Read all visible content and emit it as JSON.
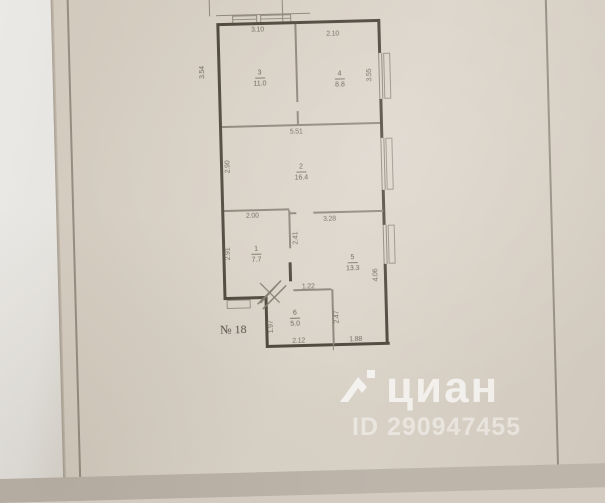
{
  "document": {
    "sheet_number": "№ 18"
  },
  "rooms": [
    {
      "number": "1",
      "area": "7.7"
    },
    {
      "number": "2",
      "area": "16.4"
    },
    {
      "number": "3",
      "area": "11.0"
    },
    {
      "number": "4",
      "area": "8.8"
    },
    {
      "number": "5",
      "area": "13.3"
    },
    {
      "number": "6",
      "area": "5.0"
    }
  ],
  "dimensions": {
    "room3_top": "3.10",
    "room4_top": "2.10",
    "room3_left": "3.54",
    "room4_right": "3.55",
    "room2_top": "5.51",
    "room2_left": "2.90",
    "room1_top": "2.00",
    "room1_left": "2.91",
    "room1_right": "2.41",
    "room5_top": "3.28",
    "room5_right": "4.06",
    "room6_top": "1.22",
    "room6_left": "1.97",
    "room6_right": "2.47",
    "room6_bottom": "2.12",
    "room5_bottom": "1.88"
  },
  "watermark": {
    "brand": "циан",
    "listing_id": "ID 290947455",
    "color": "#ffffff"
  }
}
